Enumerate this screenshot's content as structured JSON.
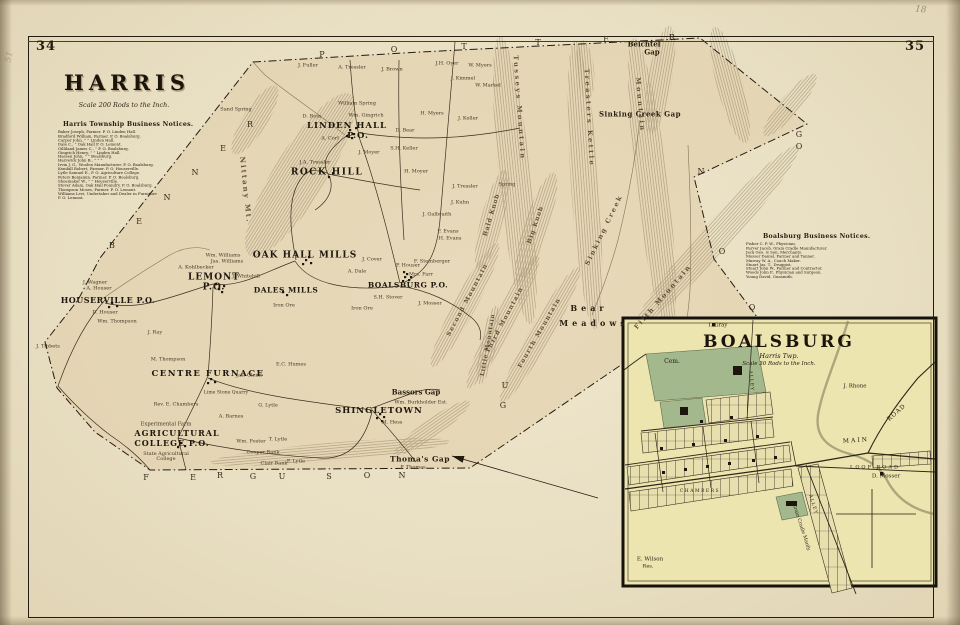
{
  "page": {
    "left_folio": "34",
    "right_folio": "35",
    "pencil_top_right": "18",
    "pencil_top_left": "51"
  },
  "harris": {
    "title": "HARRIS",
    "scale": "Scale 200 Rods to the Inch.",
    "notices_heading": "Harris Township Business Notices.",
    "notices": [
      "Baker Joseph, Farmer.  P. O. Linden Hall.",
      "Bradford William, Farmer.  P. O. Boalsburg.",
      "Carper John,      ”          ”  Linden Hall.",
      "Dale C.,      ”    Oak Hall P. O. Lemont.",
      "Gilliland James C.,   ”    P. O. Boalsburg.",
      "Gingrich Henry,    ”        ”  Linden Hall.",
      "Hassen John,      ”          ”  Boalsburg.",
      "Harswick John B.,   ”        ”        ”",
      "Irvin J. G., Woolen Manufacturer.  P. O. Boalsburg.",
      "Kendall Robert, Farmer.  P. O. Houserville.",
      "Lytle Samuel E.,  P. O. Agriculture College.",
      "Peters Benjamin, Farmer.  P. O. Boalsburg.",
      "Shoemaker W.,     ”          ”  Houserville.",
      "Stover Adam, Oak Hall Foundry.  P. O. Boalsburg.",
      "Thompson Moses, Farmer.  P. O. Lemont.",
      "Williams Levi, Undertaker and Dealer in Furniture",
      "   P. O. Lemont."
    ]
  },
  "boalsburg_notices": {
    "heading": "Boalsburg Business Notices.",
    "lines": [
      "Fisher C. P. W., Physician.",
      "Farver Jacob, Grain Cradle Manufacturer.",
      "Jack Geo. & Son, Merchants.",
      "Mosser Daniel, Farmer and Tanner.",
      "Murray W. A., Coach Maker.",
      "Stuart Jas. T., Druggist.",
      "Stuart John W., Farmer and Contractor.",
      "Woods John F., Physician and Surgeon.",
      "Young David, Gunsmith."
    ]
  },
  "map": {
    "towns": [
      {
        "t": "LINDEN HALL",
        "x": 347,
        "y": 126,
        "size": 8.5,
        "ls": 1
      },
      {
        "t": "P.O.",
        "x": 358,
        "y": 136,
        "size": 8.5,
        "ls": 1
      },
      {
        "t": "ROCK HILL",
        "x": 327,
        "y": 173,
        "size": 9,
        "ls": 1.5
      },
      {
        "t": "OAK HALL MILLS",
        "x": 305,
        "y": 256,
        "size": 9,
        "ls": 1
      },
      {
        "t": "LEMONT",
        "x": 214,
        "y": 278,
        "size": 9,
        "ls": 1
      },
      {
        "t": "P.O.",
        "x": 214,
        "y": 288,
        "size": 9,
        "ls": 1
      },
      {
        "t": "DALES MILLS",
        "x": 286,
        "y": 290,
        "size": 7.5,
        "ls": 0.5
      },
      {
        "t": "BOALSBURG P.O.",
        "x": 408,
        "y": 285,
        "size": 7.5,
        "ls": 0.5
      },
      {
        "t": "HOUSERVILLE P.O.",
        "x": 108,
        "y": 300,
        "size": 8,
        "ls": 0.5
      },
      {
        "t": "CENTRE FURNACE",
        "x": 208,
        "y": 374,
        "size": 8.5,
        "ls": 1.5
      },
      {
        "t": "AGRICULTURAL",
        "x": 177,
        "y": 433,
        "size": 8,
        "ls": 1
      },
      {
        "t": "COLLEGE P.O.",
        "x": 172,
        "y": 443,
        "size": 8,
        "ls": 1
      },
      {
        "t": "SHINGLETOWN",
        "x": 379,
        "y": 411,
        "size": 8.5,
        "ls": 1
      }
    ],
    "gaps": [
      {
        "t": "Beichtel",
        "x": 644,
        "y": 44,
        "size": 7
      },
      {
        "t": "Gap",
        "x": 652,
        "y": 52,
        "size": 7
      },
      {
        "t": "Sinking Creek Gap",
        "x": 640,
        "y": 114,
        "size": 7,
        "ls": 0.5
      },
      {
        "t": "Bassors Gap",
        "x": 416,
        "y": 392,
        "size": 7
      },
      {
        "t": "Thoma's Gap",
        "x": 420,
        "y": 459,
        "size": 7.5,
        "ls": 0.5
      },
      {
        "t": "Bear",
        "x": 589,
        "y": 308,
        "size": 8,
        "ls": 4
      },
      {
        "t": "Meadows",
        "x": 594,
        "y": 323,
        "size": 8,
        "ls": 4
      }
    ],
    "ridges": [
      {
        "t": "Nittany Mt.",
        "x": 246,
        "y": 190,
        "size": 7,
        "ls": 2,
        "rot": 84
      },
      {
        "t": "Tusseys Mountain",
        "x": 519,
        "y": 108,
        "size": 6.5,
        "ls": 2.5,
        "rot": 86
      },
      {
        "t": "Treasters Kettle",
        "x": 589,
        "y": 118,
        "size": 6.5,
        "ls": 2.5,
        "rot": 87
      },
      {
        "t": "Mountain",
        "x": 640,
        "y": 105,
        "size": 6.5,
        "ls": 2.5,
        "rot": 85
      },
      {
        "t": "Sinking Creek",
        "x": 604,
        "y": 230,
        "size": 6.5,
        "ls": 2,
        "rot": -64
      },
      {
        "t": "Bald Knob",
        "x": 492,
        "y": 215,
        "size": 6,
        "ls": 1,
        "rot": -73
      },
      {
        "t": "Big Knob",
        "x": 536,
        "y": 225,
        "size": 6,
        "ls": 1,
        "rot": -71
      },
      {
        "t": "Second Mountain",
        "x": 468,
        "y": 300,
        "size": 6,
        "ls": 1.5,
        "rot": -62
      },
      {
        "t": "Third Mountain",
        "x": 505,
        "y": 320,
        "size": 6,
        "ls": 1.5,
        "rot": -62
      },
      {
        "t": "Fourth Mountain",
        "x": 540,
        "y": 333,
        "size": 6,
        "ls": 1.5,
        "rot": -60
      },
      {
        "t": "Fifth Mountain",
        "x": 663,
        "y": 297,
        "size": 6.5,
        "ls": 2,
        "rot": -49
      },
      {
        "t": "Little Mountain",
        "x": 489,
        "y": 345,
        "size": 5.5,
        "ls": 1,
        "rot": -80
      }
    ],
    "residents": [
      {
        "t": "J. Fuller",
        "x": 308,
        "y": 66
      },
      {
        "t": "A. Tressler",
        "x": 352,
        "y": 68
      },
      {
        "t": "J. Brown",
        "x": 392,
        "y": 70
      },
      {
        "t": "J.H. Oyer",
        "x": 447,
        "y": 64
      },
      {
        "t": "W. Myers",
        "x": 480,
        "y": 66
      },
      {
        "t": "J. Kimmel",
        "x": 463,
        "y": 79
      },
      {
        "t": "W. Markel",
        "x": 488,
        "y": 86
      },
      {
        "t": "William Spring",
        "x": 357,
        "y": 104
      },
      {
        "t": "D. Ross",
        "x": 312,
        "y": 117
      },
      {
        "t": "Wm. Gingrich",
        "x": 366,
        "y": 116
      },
      {
        "t": "H. Myers",
        "x": 432,
        "y": 114
      },
      {
        "t": "J. Keller",
        "x": 468,
        "y": 119
      },
      {
        "t": "D. Bear",
        "x": 405,
        "y": 131
      },
      {
        "t": "S.H. Keller",
        "x": 404,
        "y": 149
      },
      {
        "t": "J. Moyer",
        "x": 369,
        "y": 153
      },
      {
        "t": "J.A. Tressler",
        "x": 315,
        "y": 163
      },
      {
        "t": "H. Moyer",
        "x": 416,
        "y": 172
      },
      {
        "t": "A. Corl",
        "x": 330,
        "y": 139
      },
      {
        "t": "Sand Spring",
        "x": 236,
        "y": 110
      },
      {
        "t": "J. Tressler",
        "x": 465,
        "y": 187
      },
      {
        "t": "Spring",
        "x": 507,
        "y": 185
      },
      {
        "t": "J. Kuhn",
        "x": 460,
        "y": 203
      },
      {
        "t": "J. Galbraith",
        "x": 437,
        "y": 215
      },
      {
        "t": "F. Evans",
        "x": 448,
        "y": 232
      },
      {
        "t": "H. Evans",
        "x": 450,
        "y": 239
      },
      {
        "t": "Wm. Williams",
        "x": 223,
        "y": 256
      },
      {
        "t": "Jas. Williams",
        "x": 227,
        "y": 262
      },
      {
        "t": "A. Kohlbecker",
        "x": 196,
        "y": 268
      },
      {
        "t": "J. Whitehill",
        "x": 246,
        "y": 277
      },
      {
        "t": "A. Dale",
        "x": 357,
        "y": 272
      },
      {
        "t": "J. Cover",
        "x": 372,
        "y": 260
      },
      {
        "t": "F. Steinberger",
        "x": 432,
        "y": 262
      },
      {
        "t": "P. Houser",
        "x": 408,
        "y": 266
      },
      {
        "t": "Mrs. Farr",
        "x": 421,
        "y": 275
      },
      {
        "t": "S.H. Stover",
        "x": 388,
        "y": 298
      },
      {
        "t": "J. Mosser",
        "x": 430,
        "y": 304
      },
      {
        "t": "Iron Ore",
        "x": 284,
        "y": 306
      },
      {
        "t": "Iron Ore",
        "x": 362,
        "y": 309
      },
      {
        "t": "J. Wagner",
        "x": 95,
        "y": 283
      },
      {
        "t": "A. Houser",
        "x": 99,
        "y": 289
      },
      {
        "t": "D. Houser",
        "x": 105,
        "y": 313
      },
      {
        "t": "Wm. Thompson",
        "x": 117,
        "y": 322
      },
      {
        "t": "J. Ray",
        "x": 155,
        "y": 333
      },
      {
        "t": "M. Thompson",
        "x": 168,
        "y": 360
      },
      {
        "t": "J. Tibbets",
        "x": 48,
        "y": 347
      },
      {
        "t": "Jas. Glenn",
        "x": 249,
        "y": 376
      },
      {
        "t": "E.C. Humes",
        "x": 291,
        "y": 365
      },
      {
        "t": "Lime Stone Quarry",
        "x": 226,
        "y": 394,
        "size": 4.6
      },
      {
        "t": "Rev. E. Chambers",
        "x": 176,
        "y": 405
      },
      {
        "t": "G. Lytle",
        "x": 268,
        "y": 406
      },
      {
        "t": "A. Barnes",
        "x": 231,
        "y": 417
      },
      {
        "t": "Experimental Farm",
        "x": 166,
        "y": 425,
        "size": 5.2
      },
      {
        "t": "Wm. Foster",
        "x": 251,
        "y": 442
      },
      {
        "t": "T. Lytle",
        "x": 278,
        "y": 440
      },
      {
        "t": "Cooper Bank",
        "x": 263,
        "y": 453
      },
      {
        "t": "Clair Bank",
        "x": 274,
        "y": 464
      },
      {
        "t": "P. Lytle",
        "x": 296,
        "y": 462
      },
      {
        "t": "State Agricultural College",
        "x": 166,
        "y": 457,
        "w": 64,
        "size": 5
      },
      {
        "t": "Wm. Burkholder Est.",
        "x": 421,
        "y": 403
      },
      {
        "t": "M. Hess",
        "x": 392,
        "y": 423
      },
      {
        "t": "P. Thomas",
        "x": 413,
        "y": 468
      }
    ],
    "boundary_letters": [
      {
        "t": "P",
        "x": 322,
        "y": 55
      },
      {
        "t": "O",
        "x": 394,
        "y": 50
      },
      {
        "t": "T",
        "x": 464,
        "y": 47
      },
      {
        "t": "T",
        "x": 538,
        "y": 43
      },
      {
        "t": "E",
        "x": 606,
        "y": 40
      },
      {
        "t": "R",
        "x": 672,
        "y": 38
      },
      {
        "t": "B",
        "x": 112,
        "y": 246
      },
      {
        "t": "E",
        "x": 139,
        "y": 222
      },
      {
        "t": "N",
        "x": 167,
        "y": 198
      },
      {
        "t": "N",
        "x": 195,
        "y": 173
      },
      {
        "t": "E",
        "x": 223,
        "y": 149
      },
      {
        "t": "R",
        "x": 250,
        "y": 125
      },
      {
        "t": "F",
        "x": 146,
        "y": 478
      },
      {
        "t": "E",
        "x": 193,
        "y": 478
      },
      {
        "t": "R",
        "x": 220,
        "y": 476
      },
      {
        "t": "G",
        "x": 253,
        "y": 477
      },
      {
        "t": "U",
        "x": 282,
        "y": 477
      },
      {
        "t": "S",
        "x": 329,
        "y": 477
      },
      {
        "t": "O",
        "x": 367,
        "y": 476
      },
      {
        "t": "N",
        "x": 402,
        "y": 476
      },
      {
        "t": "N",
        "x": 701,
        "y": 172
      },
      {
        "t": "O",
        "x": 722,
        "y": 252
      },
      {
        "t": "O",
        "x": 752,
        "y": 308
      },
      {
        "t": "G",
        "x": 799,
        "y": 135
      },
      {
        "t": "O",
        "x": 799,
        "y": 147
      },
      {
        "t": "U",
        "x": 505,
        "y": 386
      },
      {
        "t": "G",
        "x": 503,
        "y": 406
      }
    ]
  },
  "inset": {
    "title": "BOALSBURG",
    "subtitle": "Harris Twp.",
    "scale": "Scale 30 Rods to the Inch.",
    "labels": [
      {
        "t": "I. Gray",
        "x": 718,
        "y": 326,
        "size": 5.5
      },
      {
        "t": "Cem.",
        "x": 672,
        "y": 362,
        "size": 6
      },
      {
        "t": "J. Rhone",
        "x": 855,
        "y": 387,
        "size": 5.5
      },
      {
        "t": "MAIN",
        "x": 856,
        "y": 441,
        "size": 6,
        "ls": 2,
        "rot": -4
      },
      {
        "t": "ROAD",
        "x": 897,
        "y": 413,
        "size": 6,
        "ls": 1,
        "rot": -42
      },
      {
        "t": "LOOP ROAD",
        "x": 875,
        "y": 468,
        "size": 5,
        "ls": 2
      },
      {
        "t": "D. Mosser",
        "x": 886,
        "y": 477,
        "size": 5.5
      },
      {
        "t": "CHAMBERS",
        "x": 700,
        "y": 492,
        "size": 4.5,
        "ls": 1.5
      },
      {
        "t": "ALLEY",
        "x": 750,
        "y": 381,
        "size": 4.5,
        "ls": 1,
        "rot": 85
      },
      {
        "t": "ALLEY",
        "x": 812,
        "y": 505,
        "size": 4.5,
        "ls": 1,
        "rot": 72
      },
      {
        "t": "Grain Cradle Manfy.",
        "x": 800,
        "y": 528,
        "size": 4.8,
        "rot": 72
      },
      {
        "t": "E. Wilson",
        "x": 650,
        "y": 560,
        "size": 5.5
      },
      {
        "t": "Res.",
        "x": 648,
        "y": 567,
        "size": 5
      }
    ]
  }
}
